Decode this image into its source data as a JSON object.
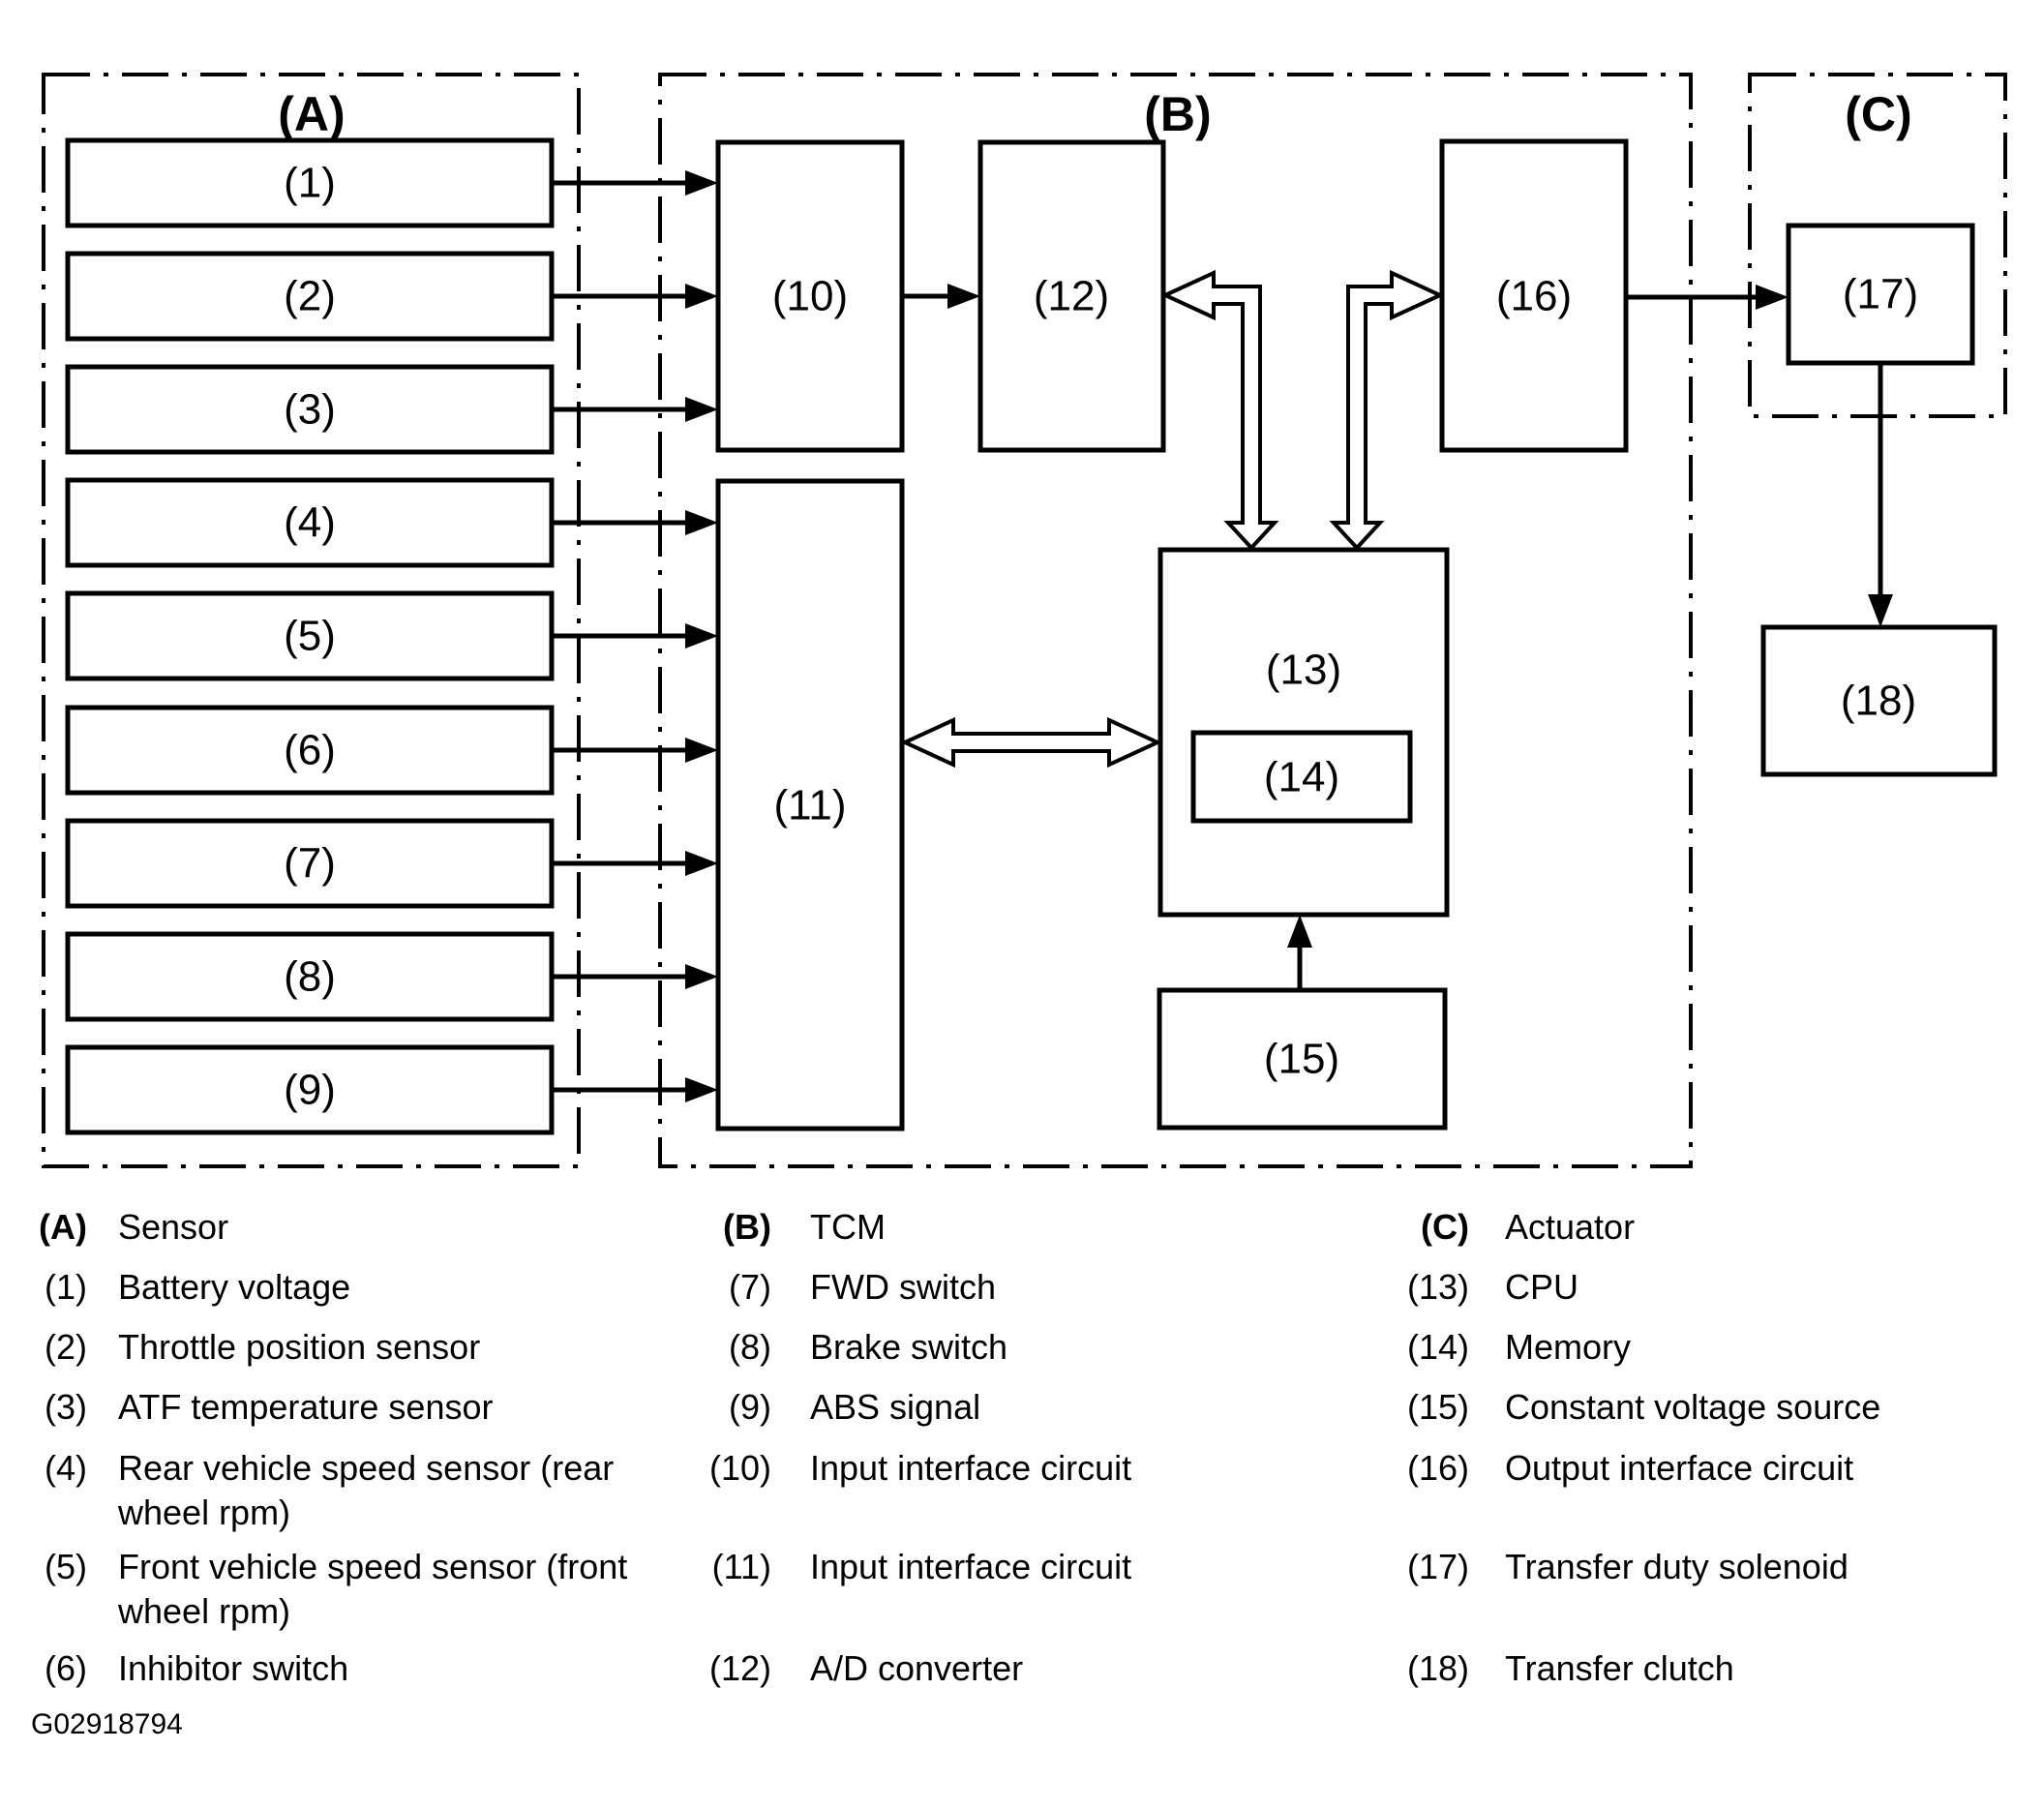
{
  "figure": {
    "sections": {
      "a": "(A)",
      "b": "(B)",
      "c": "(C)"
    },
    "boxes": {
      "n1": "(1)",
      "n2": "(2)",
      "n3": "(3)",
      "n4": "(4)",
      "n5": "(5)",
      "n6": "(6)",
      "n7": "(7)",
      "n8": "(8)",
      "n9": "(9)",
      "n10": "(10)",
      "n11": "(11)",
      "n12": "(12)",
      "n13": "(13)",
      "n14": "(14)",
      "n15": "(15)",
      "n16": "(16)",
      "n17": "(17)",
      "n18": "(18)"
    },
    "footer_id": "G02918794",
    "line_color": "#000000",
    "background_color": "#ffffff"
  },
  "legend": {
    "columns": [
      {
        "header": {
          "tag": "(A)",
          "label": "Sensor"
        },
        "items": [
          {
            "tag": "(1)",
            "lines": [
              "Battery voltage"
            ]
          },
          {
            "tag": "(2)",
            "lines": [
              "Throttle position sensor"
            ]
          },
          {
            "tag": "(3)",
            "lines": [
              "ATF temperature sensor"
            ]
          },
          {
            "tag": "(4)",
            "lines": [
              "Rear vehicle speed sensor (rear",
              "wheel rpm)"
            ]
          },
          {
            "tag": "(5)",
            "lines": [
              "Front vehicle speed sensor (front",
              "wheel rpm)"
            ]
          },
          {
            "tag": "(6)",
            "lines": [
              "Inhibitor switch"
            ]
          }
        ]
      },
      {
        "header": {
          "tag": "(B)",
          "label": "TCM"
        },
        "items": [
          {
            "tag": "(7)",
            "lines": [
              "FWD switch"
            ]
          },
          {
            "tag": "(8)",
            "lines": [
              "Brake switch"
            ]
          },
          {
            "tag": "(9)",
            "lines": [
              "ABS signal"
            ]
          },
          {
            "tag": "(10)",
            "lines": [
              "Input interface circuit"
            ]
          },
          {
            "tag": "(11)",
            "lines": [
              "Input interface circuit"
            ]
          },
          {
            "tag": "(12)",
            "lines": [
              "A/D converter"
            ]
          }
        ]
      },
      {
        "header": {
          "tag": "(C)",
          "label": "Actuator"
        },
        "items": [
          {
            "tag": "(13)",
            "lines": [
              "CPU"
            ]
          },
          {
            "tag": "(14)",
            "lines": [
              "Memory"
            ]
          },
          {
            "tag": "(15)",
            "lines": [
              "Constant voltage source"
            ]
          },
          {
            "tag": "(16)",
            "lines": [
              "Output interface circuit"
            ]
          },
          {
            "tag": "(17)",
            "lines": [
              "Transfer duty solenoid"
            ]
          },
          {
            "tag": "(18)",
            "lines": [
              "Transfer clutch"
            ]
          }
        ]
      }
    ]
  }
}
